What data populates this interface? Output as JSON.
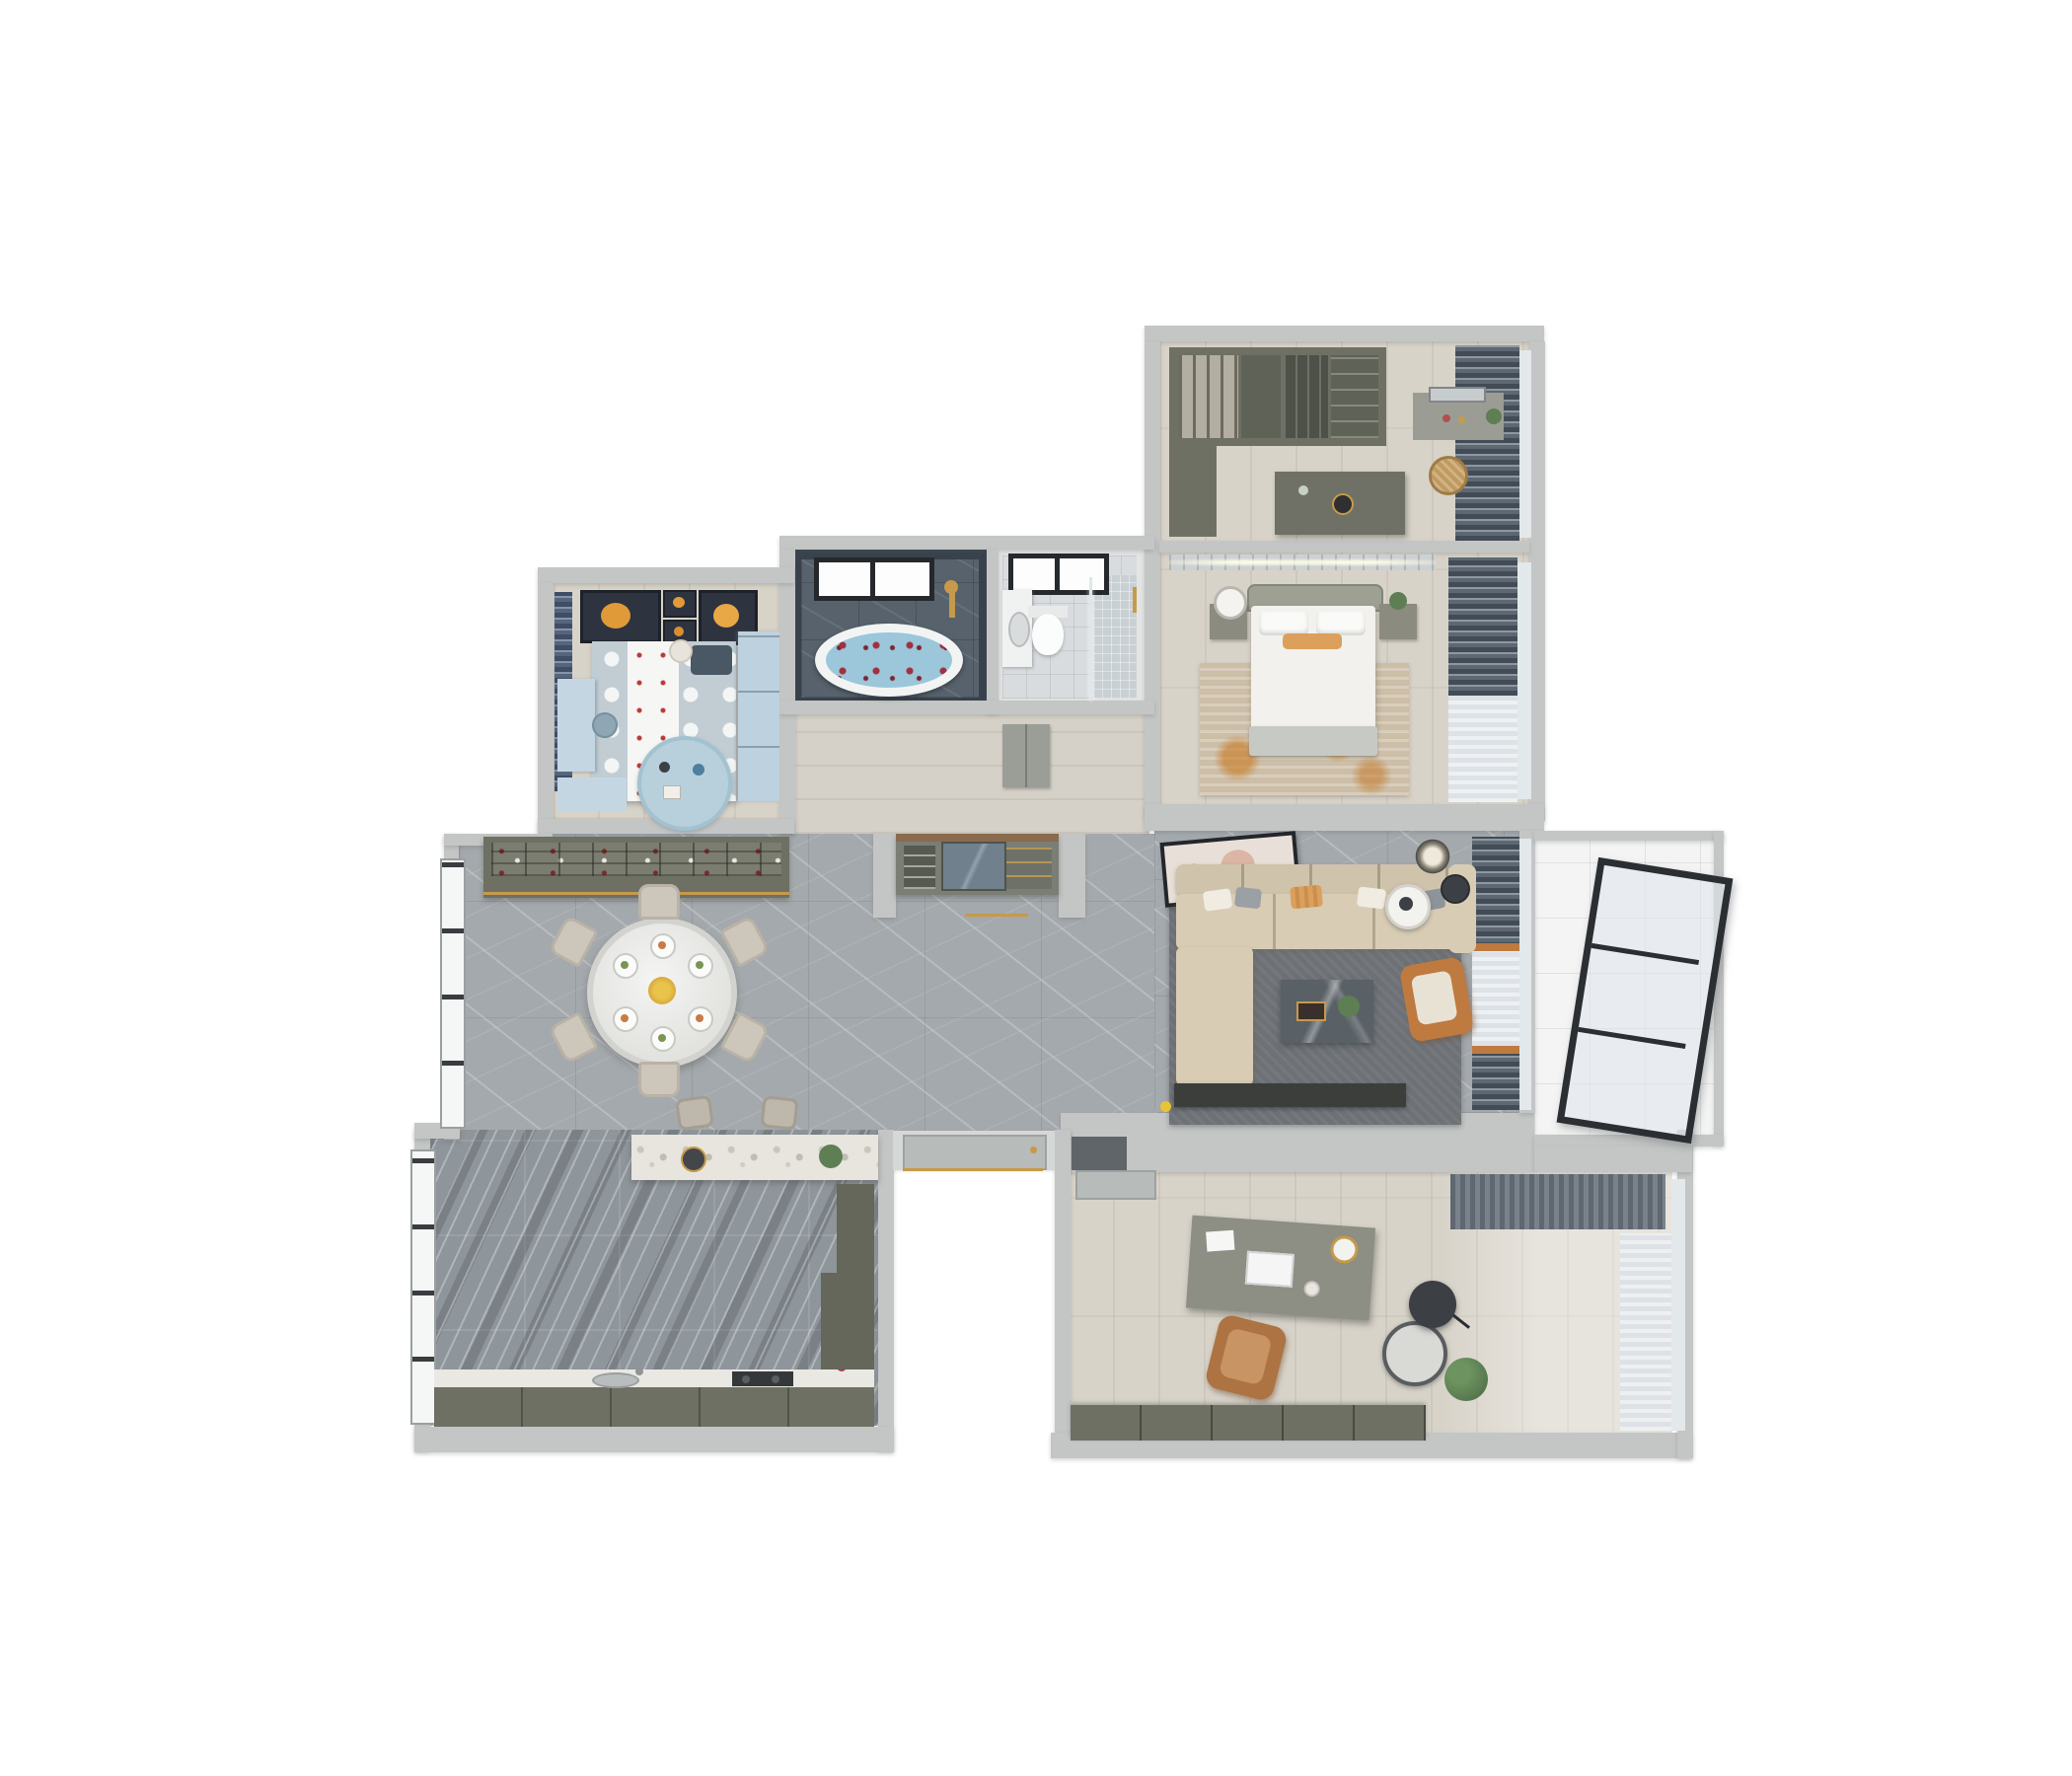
{
  "scene": {
    "type": "3d-floor-plan-render",
    "view": "top-down-dollhouse",
    "background": "#ffffff",
    "description": "Top-down 3D render of a furnished apartment floor plan with cutaway walls"
  },
  "colors": {
    "wall": "#c3c6c4",
    "wood": "#d8d3c9",
    "marble": "#a4a9ad",
    "kitchenTile": "#8e959b",
    "slate": "#57626c",
    "slateDeep": "#39424c",
    "tileLight": "#d9dcde",
    "balconyFloor": "#f3f4f3",
    "olive": "#6e7063",
    "oliveDark": "#5f6257",
    "sofa": "#d8ccb5",
    "sofaCushion": "#cfc3ac",
    "orange": "#bf7a40",
    "accentOrange": "#dca05c",
    "curtainDark": "#434c56",
    "curtainBlue": "#5a6673",
    "kidBlue": "#bdd1de",
    "kidBed": "#c1ccd3",
    "rugGray": "#6e7277",
    "rugBeige": "#ccbea7",
    "gold": "#c59a4a",
    "water": "#9cc6da",
    "plantGreen": "#5d7f53",
    "frameDark": "#2e3340",
    "doorGray": "#b7bbba",
    "consoleGray": "#7a7e74",
    "tableMarble": "#596066"
  },
  "rooms": [
    {
      "id": "walk-in-closet",
      "name": "Walk-in Closet",
      "furniture": [
        "wardrobe-run",
        "open-hanging-sections",
        "island-dresser",
        "vanity-table",
        "mirror",
        "laundry-basket",
        "blackout-curtains",
        "window"
      ]
    },
    {
      "id": "master-bedroom",
      "name": "Master Bedroom",
      "furniture": [
        "double-bed",
        "headboard",
        "pillows",
        "orange-lumbar-pillow",
        "nightstand-left",
        "table-lamp",
        "nightstand-right",
        "potted-plant",
        "area-rug",
        "blackout-curtains",
        "window"
      ]
    },
    {
      "id": "bathroom",
      "name": "Bathroom",
      "furniture": [
        "freestanding-bathtub",
        "rose-petals",
        "black-frame-window",
        "gold-shower-set"
      ]
    },
    {
      "id": "shower-room",
      "name": "Shower Room",
      "furniture": [
        "wall-hung-toilet",
        "vanity-sink",
        "walk-in-shower",
        "glass-screen",
        "gold-towel-bar",
        "black-frame-window"
      ]
    },
    {
      "id": "suite-corridor",
      "name": "Suite Corridor",
      "furniture": [
        "linen-cabinet"
      ]
    },
    {
      "id": "kids-bedroom",
      "name": "Kids Bedroom",
      "furniture": [
        "polka-dot-bed",
        "white-runner",
        "teddy-bear",
        "pillow",
        "wardrobe",
        "study-desk",
        "desk-chair",
        "window-bench",
        "round-play-rug",
        "toys",
        "planet-wall-art-x3",
        "blue-curtains"
      ]
    },
    {
      "id": "dining-room",
      "name": "Dining Room",
      "furniture": [
        "round-dining-table",
        "dining-chairs-x6",
        "place-settings",
        "flower-centerpiece",
        "wine-sideboard",
        "display-shelves",
        "window-wall"
      ]
    },
    {
      "id": "hallway",
      "name": "Hallway",
      "furniture": [
        "entry-console",
        "console-mirror",
        "shoe-shelves",
        "gold-floor-inlay"
      ]
    },
    {
      "id": "kitchen",
      "name": "Kitchen",
      "furniture": [
        "counter-run",
        "sink",
        "gas-cooktop",
        "red-kettle",
        "tall-cabinet",
        "island-bar",
        "bar-stools-x2",
        "island-plant",
        "serving-tray",
        "window-wall"
      ]
    },
    {
      "id": "living-room",
      "name": "Living Room",
      "furniture": [
        "sectional-sofa",
        "throw-pillows",
        "coffee-table",
        "orange-armchair",
        "side-table",
        "floor-lamp",
        "area-rug",
        "tv-console",
        "toy-duck",
        "leaning-artwork",
        "ring-ceiling-light",
        "curtains"
      ]
    },
    {
      "id": "balcony",
      "name": "Balcony",
      "furniture": [
        "sliding-glass-door"
      ]
    },
    {
      "id": "study",
      "name": "Study",
      "furniture": [
        "writing-desk",
        "laptop",
        "desk-lamp",
        "office-chair",
        "lounge-chair",
        "arc-floor-lamp",
        "potted-plant",
        "low-bookcase",
        "pleated-curtain",
        "sheer-curtain",
        "entry-door-mat",
        "door"
      ]
    },
    {
      "id": "entry",
      "name": "Entry",
      "furniture": [
        "entry-door",
        "gold-threshold"
      ]
    }
  ]
}
